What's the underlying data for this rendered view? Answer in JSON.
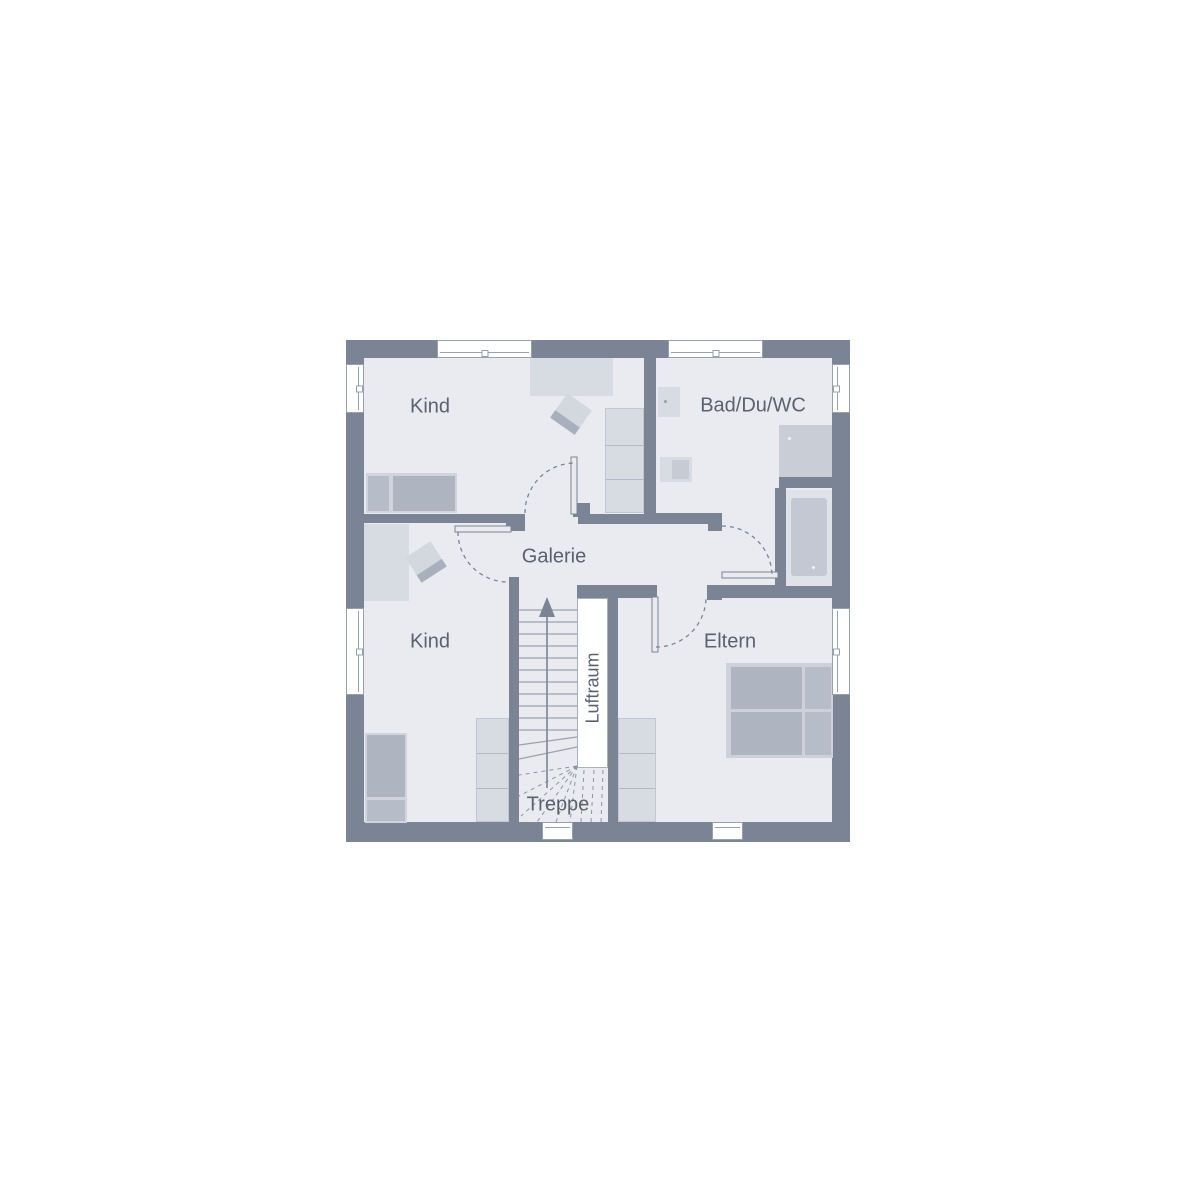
{
  "floorplan": {
    "title": "Obergeschoss Grundriss",
    "labels": {
      "kind_top": "Kind",
      "bad": "Bad/Du/WC",
      "galerie": "Galerie",
      "kind_bottom": "Kind",
      "eltern": "Eltern",
      "treppe": "Treppe",
      "luftraum": "Luftraum"
    },
    "colors": {
      "wall": "#7b8494",
      "floor": "#e9ebf0",
      "furniture_light": "#d7dbe2",
      "furniture_medium": "#aeb5c1",
      "window_frame": "#97a0ad",
      "text": "#5a6270",
      "background": "#ffffff"
    }
  }
}
